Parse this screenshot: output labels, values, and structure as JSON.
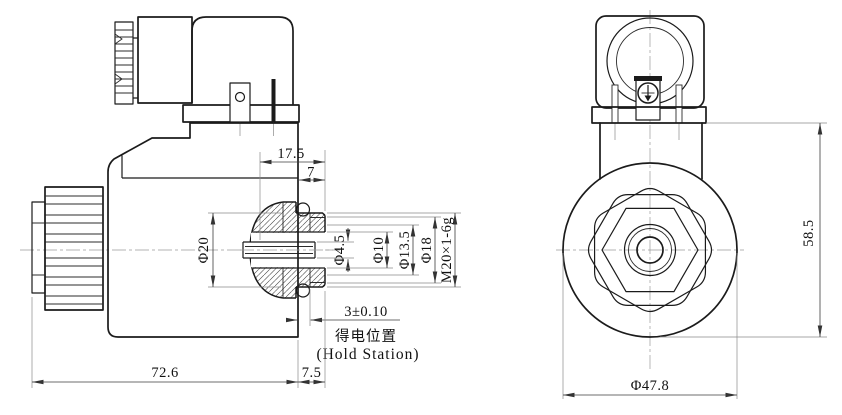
{
  "drawing": {
    "side_view": {
      "dim_17_5": "17.5",
      "dim_7": "7",
      "dim_phi20": "Φ20",
      "dim_phi4_5": "Φ4.5",
      "dim_phi10": "Φ10",
      "dim_phi13_5": "Φ13.5",
      "dim_phi18": "Φ18",
      "dim_thread": "M20×1-6g",
      "dim_stroke": "3±0.10",
      "stroke_label_cn": "得电位置",
      "stroke_label_en": "(Hold Station)",
      "dim_72_6": "72.6",
      "dim_7_5": "7.5"
    },
    "front_view": {
      "dim_58_5": "58.5",
      "dim_phi47_8": "Φ47.8"
    }
  }
}
